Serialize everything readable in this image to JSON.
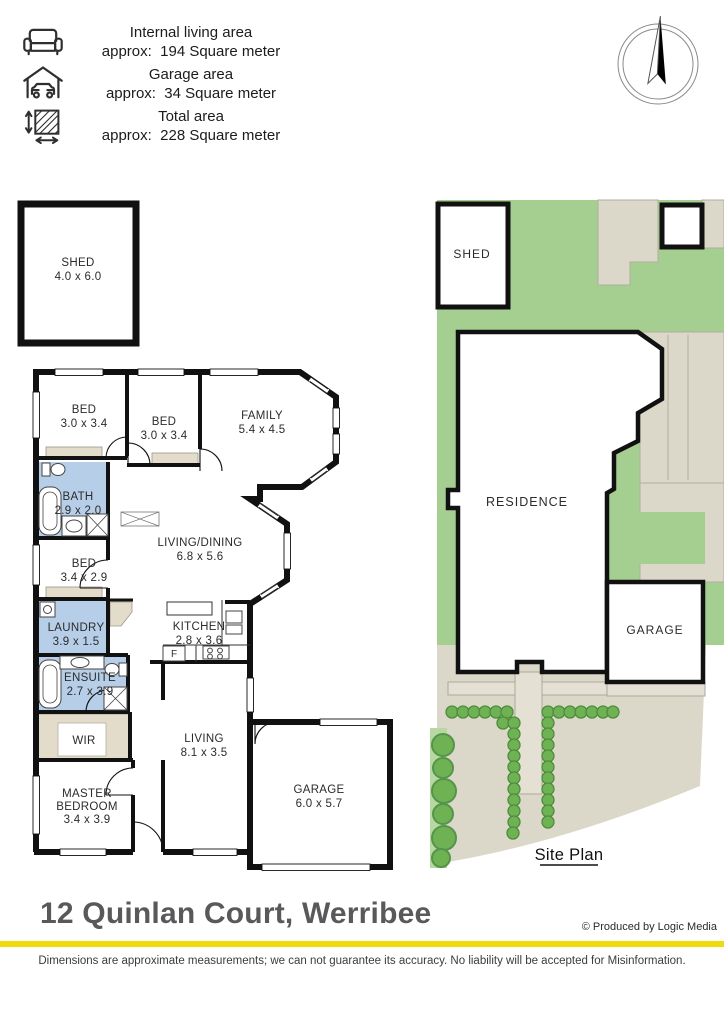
{
  "legend": {
    "items": [
      {
        "icon": "sofa-icon",
        "title": "Internal living area",
        "value": "approx:  194 Square meter"
      },
      {
        "icon": "garage-icon",
        "title": "Garage area",
        "value": "approx:  34 Square meter"
      },
      {
        "icon": "area-icon",
        "title": "Total area",
        "value": "approx:  228 Square meter"
      }
    ]
  },
  "floorplan": {
    "rooms": [
      {
        "id": "shed",
        "lines": [
          "SHED",
          "4.0 x 6.0"
        ]
      },
      {
        "id": "bed-1",
        "lines": [
          "BED",
          "3.0 x 3.4"
        ]
      },
      {
        "id": "bed-2",
        "lines": [
          "BED",
          "3.0 x 3.4"
        ]
      },
      {
        "id": "family",
        "lines": [
          "FAMILY",
          "5.4 x 4.5"
        ]
      },
      {
        "id": "bath",
        "lines": [
          "BATH",
          "2.9 x 2.0"
        ]
      },
      {
        "id": "bed-3",
        "lines": [
          "BED",
          "3.4 x 2.9"
        ]
      },
      {
        "id": "living-dining",
        "lines": [
          "LIVING/DINING",
          "6.8 x 5.6"
        ]
      },
      {
        "id": "laundry",
        "lines": [
          "LAUNDRY",
          "3.9 x 1.5"
        ]
      },
      {
        "id": "kitchen",
        "lines": [
          "KITCHEN",
          "2.8 x 3.6"
        ]
      },
      {
        "id": "ensuite",
        "lines": [
          "ENSUITE",
          "2.7 x 3.9"
        ]
      },
      {
        "id": "wir",
        "lines": [
          "WIR"
        ]
      },
      {
        "id": "living",
        "lines": [
          "LIVING",
          "8.1 x 3.5"
        ]
      },
      {
        "id": "master-bedroom",
        "lines": [
          "MASTER",
          "BEDROOM",
          "3.4 x 3.9"
        ]
      },
      {
        "id": "garage",
        "lines": [
          "GARAGE",
          "6.0 x 5.7"
        ]
      }
    ],
    "fridge_label": "F"
  },
  "siteplan": {
    "shed_label": "SHED",
    "residence_label": "RESIDENCE",
    "garage_label": "GARAGE",
    "caption": "Site Plan"
  },
  "footer": {
    "address": "12 Quinlan Court, Werribee",
    "credit": "© Produced by Logic Media",
    "disclaimer": "Dimensions are approximate measurements; we can not guarantee its accuracy. No liability will be accepted for Misinformation."
  },
  "colors": {
    "accent_yellow": "#F2DB0C",
    "wet_area_blue": "#B7CEE8",
    "robe_tan": "#E3DCCA",
    "grass_green": "#A5CF90",
    "shrub_green": "#6FB254",
    "paving_beige": "#DCD8C9"
  }
}
